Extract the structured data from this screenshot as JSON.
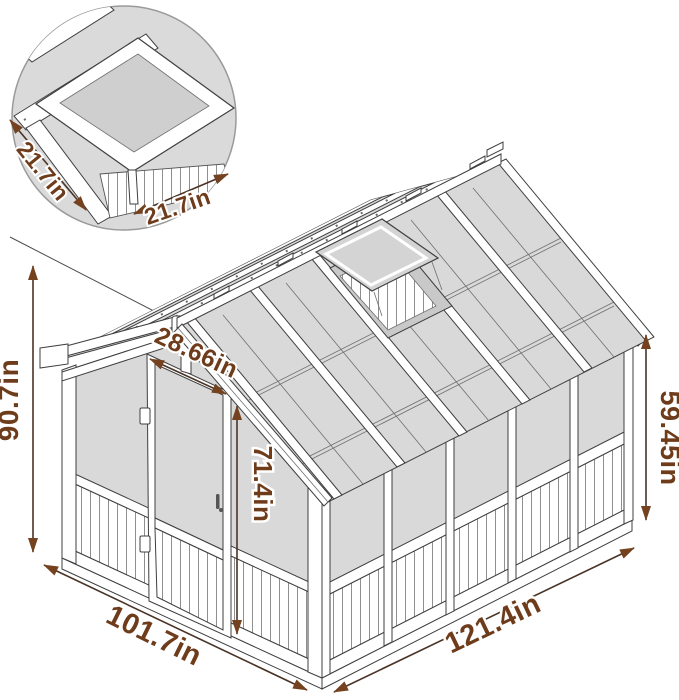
{
  "figure": {
    "kind": "greenhouse-dimension-diagram",
    "units": "in",
    "labels": {
      "total_height": "90.7in",
      "side_wall_height": "59.45in",
      "door_height": "71.4in",
      "door_width": "28.66in",
      "gable_side_length": "101.7in",
      "long_side_length": "121.4in",
      "vent_side_a": "21.7in",
      "vent_side_b": "21.7in"
    },
    "colors": {
      "dimension_text": "#6e3c1b",
      "dimension_line": "#4a3426",
      "arrow_fill": "#74421f",
      "drawing_outline": "#3f3f3f",
      "panel_gray": "#d9d9d9",
      "frame_white": "#ffffff"
    }
  }
}
